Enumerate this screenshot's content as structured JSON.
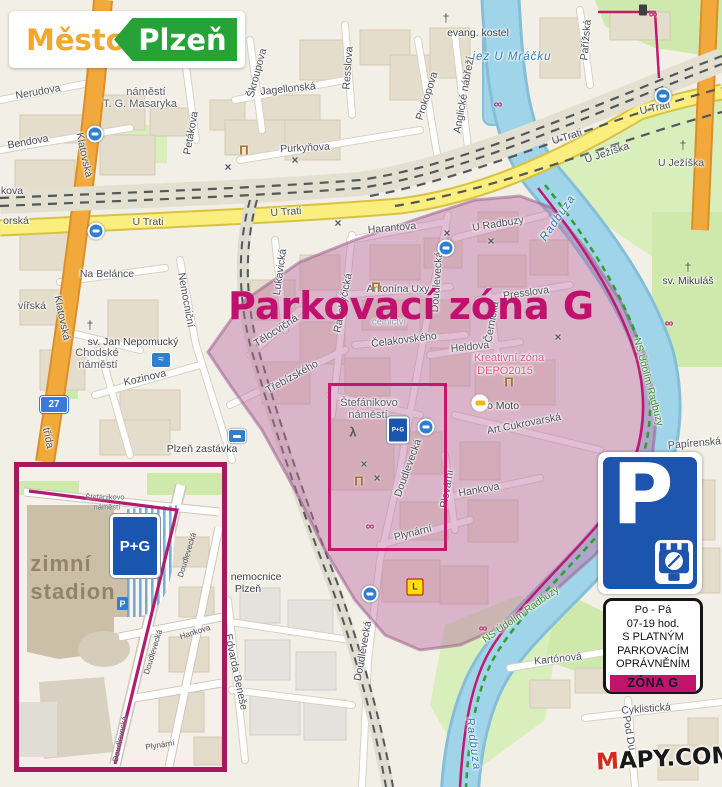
{
  "logo": {
    "city": "Město",
    "name": "Plzeň"
  },
  "title": "Parkovací zóna G",
  "watermark": {
    "m": "M",
    "rest": "APY.COM"
  },
  "badge27": "27",
  "colors": {
    "zone_magenta": "#c0156b",
    "logo_orange": "#f2a72d",
    "logo_green": "#27a237",
    "sign_blue": "#1c54ae",
    "water": "#a0d4e8",
    "road_yellow": "#f9ee7e"
  },
  "sign": {
    "p": "P",
    "lines": [
      "Po - Pá",
      "07-19 hod.",
      "S PLATNÝM",
      "PARKOVACÍM",
      "OPRÁVNĚNÍM"
    ],
    "zone": "ZÓNA G"
  },
  "inset": {
    "pg": "P+G",
    "labels": [
      {
        "t": "Štefánikovo",
        "x": 86,
        "y": 30,
        "c": "tiny"
      },
      {
        "t": "náměstí",
        "x": 88,
        "y": 40,
        "c": "tiny"
      },
      {
        "t": "zimní",
        "x": 42,
        "y": 97,
        "c": "big"
      },
      {
        "t": "stadion",
        "x": 54,
        "y": 125,
        "c": "big"
      },
      {
        "t": "Doudlevecká",
        "x": 168,
        "y": 88,
        "r": -73
      },
      {
        "t": "Doudlevecká",
        "x": 134,
        "y": 185,
        "r": -73
      },
      {
        "t": "Doudlevecká",
        "x": 101,
        "y": 272,
        "r": -78
      },
      {
        "t": "Hankova",
        "x": 176,
        "y": 165,
        "r": -18
      },
      {
        "t": "Plynární",
        "x": 141,
        "y": 278,
        "r": -9
      }
    ]
  },
  "map": {
    "icon_glyphs": {
      "stop": "",
      "museum": "Π",
      "tools": "×",
      "bike": "∞",
      "church": "†",
      "swim": "≈",
      "train": "",
      "lidl": "L",
      "car": "",
      "trash": "",
      "pg": "P+G",
      "skater": "λ"
    },
    "labels": [
      {
        "t": "Nerudova",
        "x": 38,
        "y": 92,
        "r": -10
      },
      {
        "t": "náměstí",
        "x": 146,
        "y": 92,
        "c": "a"
      },
      {
        "t": "T. G. Masaryka",
        "x": 140,
        "y": 104,
        "c": "a"
      },
      {
        "t": "Bendova",
        "x": 28,
        "y": 142,
        "r": -10
      },
      {
        "t": "Petákova",
        "x": 191,
        "y": 133,
        "r": -80
      },
      {
        "t": "Škroupova",
        "x": 257,
        "y": 73,
        "r": -75
      },
      {
        "t": "Jagellonská",
        "x": 288,
        "y": 89,
        "r": -6
      },
      {
        "t": "Resslova",
        "x": 348,
        "y": 68,
        "r": -86
      },
      {
        "t": "Prokopova",
        "x": 427,
        "y": 96,
        "r": -72
      },
      {
        "t": "Purkyňova",
        "x": 305,
        "y": 148,
        "r": -3
      },
      {
        "t": "evang. kostel",
        "x": 478,
        "y": 33,
        "c": "p"
      },
      {
        "t": "jez U Mráčku",
        "x": 512,
        "y": 57,
        "c": "w"
      },
      {
        "t": "Pařížská",
        "x": 586,
        "y": 40,
        "r": -85
      },
      {
        "t": "Anglické nábřeží",
        "x": 464,
        "y": 95,
        "r": -80
      },
      {
        "t": "U Trati",
        "x": 148,
        "y": 222
      },
      {
        "t": "U Trati",
        "x": 286,
        "y": 212,
        "r": -4
      },
      {
        "t": "U Trati",
        "x": 567,
        "y": 137,
        "r": -17
      },
      {
        "t": "U Trati",
        "x": 655,
        "y": 108,
        "r": -13
      },
      {
        "t": "U Ježíška",
        "x": 607,
        "y": 153,
        "r": -18
      },
      {
        "t": "U Ježíška",
        "x": 681,
        "y": 163
      },
      {
        "t": "Klatovská",
        "x": 84,
        "y": 155,
        "r": 78
      },
      {
        "t": "Klatovská",
        "x": 62,
        "y": 318,
        "r": 78
      },
      {
        "t": "třída",
        "x": 48,
        "y": 438,
        "r": 78
      },
      {
        "t": "Na Belánce",
        "x": 107,
        "y": 274
      },
      {
        "t": "kova",
        "x": 12,
        "y": 191
      },
      {
        "t": "orská",
        "x": 16,
        "y": 221
      },
      {
        "t": "vířská",
        "x": 32,
        "y": 306
      },
      {
        "t": "sv. Jan Nepomucký",
        "x": 133,
        "y": 342,
        "c": "p"
      },
      {
        "t": "Chodské",
        "x": 97,
        "y": 353,
        "c": "a"
      },
      {
        "t": "náměstí",
        "x": 98,
        "y": 365,
        "c": "a"
      },
      {
        "t": "Kozinova",
        "x": 145,
        "y": 378,
        "r": -13
      },
      {
        "t": "Plzeň zastávka",
        "x": 202,
        "y": 449,
        "c": "p"
      },
      {
        "t": "Nemocniční",
        "x": 186,
        "y": 300,
        "r": 80
      },
      {
        "t": "Harantova",
        "x": 392,
        "y": 228,
        "r": -5
      },
      {
        "t": "Lukavická",
        "x": 280,
        "y": 272,
        "r": -82
      },
      {
        "t": "Radobyčická",
        "x": 343,
        "y": 303,
        "r": -79
      },
      {
        "t": "Doudlevecká",
        "x": 437,
        "y": 282,
        "r": -86
      },
      {
        "t": "Antonína Uxy",
        "x": 398,
        "y": 289
      },
      {
        "t": "celnictví",
        "x": 389,
        "y": 322,
        "c": "f"
      },
      {
        "t": "Tělocvičná",
        "x": 276,
        "y": 331,
        "r": -33
      },
      {
        "t": "Třebízského",
        "x": 292,
        "y": 377,
        "r": -29
      },
      {
        "t": "Čelakovského",
        "x": 404,
        "y": 340,
        "r": -7
      },
      {
        "t": "Heldova",
        "x": 470,
        "y": 347,
        "r": -6
      },
      {
        "t": "Presslova",
        "x": 526,
        "y": 293,
        "r": -8
      },
      {
        "t": "Černická",
        "x": 492,
        "y": 322,
        "r": -80
      },
      {
        "t": "U Radbuzy",
        "x": 498,
        "y": 224,
        "r": -9
      },
      {
        "t": "Radbuza",
        "x": 558,
        "y": 218,
        "r": -55,
        "c": "w"
      },
      {
        "t": "Radbuza",
        "x": 473,
        "y": 744,
        "r": 82,
        "c": "w"
      },
      {
        "t": "sv. Mikuláš",
        "x": 688,
        "y": 281,
        "c": "p"
      },
      {
        "t": "NS Údolím Radbuzy",
        "x": 648,
        "y": 382,
        "r": 75,
        "c": "t"
      },
      {
        "t": "NS Údolím Radbuzy",
        "x": 521,
        "y": 615,
        "r": -35,
        "c": "t"
      },
      {
        "t": "Kreativní zóna",
        "x": 509,
        "y": 358,
        "c": "d"
      },
      {
        "t": "DEPO2015",
        "x": 505,
        "y": 371,
        "c": "d"
      },
      {
        "t": "o Moto",
        "x": 503,
        "y": 406,
        "c": "p"
      },
      {
        "t": "Art Cukrovarská",
        "x": 524,
        "y": 424,
        "r": -11
      },
      {
        "t": "Štefánikovo",
        "x": 369,
        "y": 403,
        "c": "a"
      },
      {
        "t": "náměstí",
        "x": 368,
        "y": 415,
        "c": "a"
      },
      {
        "t": "Plovární",
        "x": 447,
        "y": 489,
        "r": -80
      },
      {
        "t": "Hankova",
        "x": 479,
        "y": 490,
        "r": -10
      },
      {
        "t": "Plynární",
        "x": 413,
        "y": 533,
        "r": -14
      },
      {
        "t": "Doudlevecká",
        "x": 408,
        "y": 468,
        "r": -70
      },
      {
        "t": "Doudlevecká",
        "x": 363,
        "y": 651,
        "r": -80
      },
      {
        "t": "Fakultní nemocnice",
        "x": 236,
        "y": 577,
        "c": "p"
      },
      {
        "t": "Plzeň",
        "x": 248,
        "y": 589,
        "c": "p"
      },
      {
        "t": "Edvarda Beneše",
        "x": 236,
        "y": 672,
        "r": 78
      },
      {
        "t": "Kartónová",
        "x": 558,
        "y": 659,
        "r": -6
      },
      {
        "t": "Cyklistická",
        "x": 646,
        "y": 709,
        "r": -4
      },
      {
        "t": "Pod Du",
        "x": 629,
        "y": 733,
        "r": 80
      },
      {
        "t": "Papírenská lá",
        "x": 700,
        "y": 443,
        "r": -5
      }
    ],
    "icons": [
      {
        "k": "stop",
        "x": 96,
        "y": 231
      },
      {
        "k": "stop",
        "x": 95,
        "y": 134
      },
      {
        "k": "stop",
        "x": 663,
        "y": 96
      },
      {
        "k": "stop",
        "x": 426,
        "y": 427
      },
      {
        "k": "stop",
        "x": 370,
        "y": 594
      },
      {
        "k": "stop",
        "x": 446,
        "y": 248
      },
      {
        "k": "museum",
        "x": 376,
        "y": 287
      },
      {
        "k": "museum",
        "x": 244,
        "y": 150
      },
      {
        "k": "museum",
        "x": 359,
        "y": 481
      },
      {
        "k": "museum",
        "x": 509,
        "y": 382
      },
      {
        "k": "tools",
        "x": 295,
        "y": 160
      },
      {
        "k": "tools",
        "x": 228,
        "y": 167
      },
      {
        "k": "tools",
        "x": 338,
        "y": 223
      },
      {
        "k": "tools",
        "x": 447,
        "y": 233
      },
      {
        "k": "tools",
        "x": 491,
        "y": 241
      },
      {
        "k": "tools",
        "x": 558,
        "y": 337
      },
      {
        "k": "tools",
        "x": 364,
        "y": 464
      },
      {
        "k": "tools",
        "x": 377,
        "y": 478
      },
      {
        "k": "bike",
        "x": 653,
        "y": 14
      },
      {
        "k": "bike",
        "x": 498,
        "y": 104
      },
      {
        "k": "bike",
        "x": 370,
        "y": 526
      },
      {
        "k": "bike",
        "x": 669,
        "y": 323
      },
      {
        "k": "bike",
        "x": 483,
        "y": 628
      },
      {
        "k": "church",
        "x": 446,
        "y": 18
      },
      {
        "k": "church",
        "x": 90,
        "y": 325
      },
      {
        "k": "church",
        "x": 688,
        "y": 267
      },
      {
        "k": "church",
        "x": 683,
        "y": 145
      },
      {
        "k": "swim",
        "x": 161,
        "y": 360
      },
      {
        "k": "train",
        "x": 237,
        "y": 436
      },
      {
        "k": "lidl",
        "x": 415,
        "y": 587
      },
      {
        "k": "car",
        "x": 480,
        "y": 403
      },
      {
        "k": "trash",
        "x": 643,
        "y": 10
      },
      {
        "k": "skater",
        "x": 353,
        "y": 432
      },
      {
        "k": "pg",
        "x": 398,
        "y": 430
      }
    ]
  }
}
